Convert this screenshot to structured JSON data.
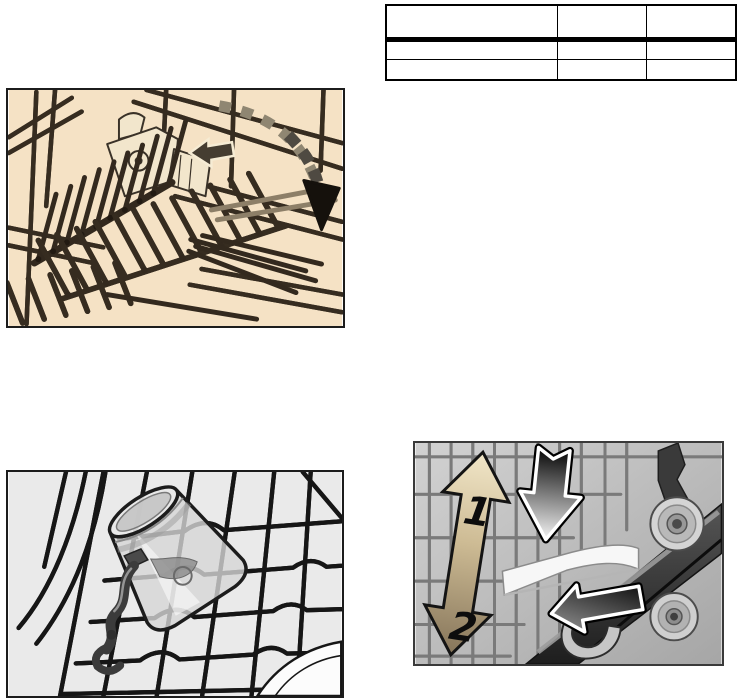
{
  "page": {
    "width": 738,
    "height": 700,
    "background": "#ffffff"
  },
  "table": {
    "position": "top-right",
    "header": [
      "",
      "",
      ""
    ],
    "rows": [
      [
        "",
        "",
        ""
      ],
      [
        "",
        "",
        ""
      ]
    ]
  },
  "figures": {
    "folding_spikes": {
      "caption": "",
      "background_color": "#f5e2c5",
      "spike_color": "#33291e",
      "wire_color": "#f9f0da",
      "arrow_style": "dashed curve with solid black head, folding direction down-right"
    },
    "small_parts_holder": {
      "caption": "",
      "background_color": "#eaeaea",
      "wire_color": "#ffffff",
      "clip_color": "#3b3b3b"
    },
    "rack_height_adjust": {
      "caption": "",
      "label_up": "1",
      "label_down": "2",
      "double_arrow_top_color": "#f1e6c8",
      "double_arrow_bottom_color": "#86755a",
      "press_arrow_gradient": "black to white",
      "pull_arrow_gradient": "gray to black"
    }
  }
}
